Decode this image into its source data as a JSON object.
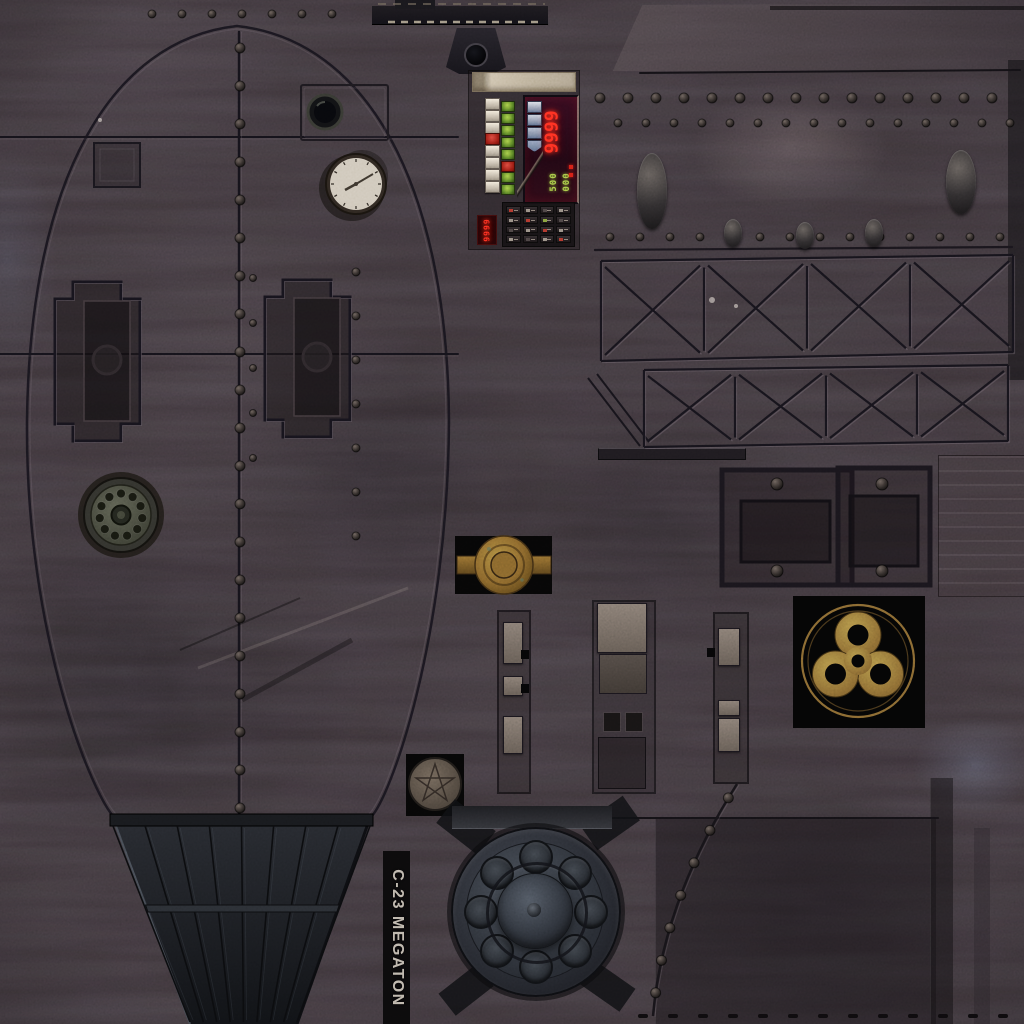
{
  "texture_label": {
    "text": "C-23 MEGATON"
  },
  "control_panel": {
    "main_display": {
      "value": "9999"
    },
    "aux_display": {
      "line1": "500",
      "line2": "000"
    },
    "side_display": {
      "value": "9999"
    },
    "left_buttons": [
      "white",
      "white",
      "white",
      "red",
      "white",
      "white",
      "white",
      "white"
    ],
    "right_buttons": [
      "green",
      "green",
      "green",
      "green",
      "green",
      "red",
      "green",
      "green"
    ],
    "display_buttons": [
      "#d7dce4",
      "#c3cbd8",
      "#a8b4c6",
      "#8799b6"
    ],
    "display_indicators": [
      "#d01e14",
      "#d01e14"
    ],
    "keypad_indicators": [
      "#a8342a",
      "#8d857a",
      "#46403f",
      "#8d857a",
      "#8d857a",
      "#a8342a",
      "#7a9a37",
      "#46403f",
      "#46403f",
      "#8d857a",
      "#a8342a",
      "#8d857a",
      "#8d857a",
      "#46403f",
      "#8d857a",
      "#a8342a"
    ]
  },
  "colors": {
    "background": "#332c2f",
    "display_red": "#ff2d1f",
    "display_green": "#9fc544",
    "brass": "#a5823c",
    "hazard_gold": "#a8873f",
    "clock_face": "#cac3b4",
    "stencil_text": "#b5afa3"
  },
  "icons": {
    "biohazard": "biohazard-symbol",
    "clock": "clock-gauge",
    "rotary_dial": "rotary-dial",
    "porthole": "porthole-window",
    "valve_hub": "brass-valve-hub",
    "round_emblem": "worn-round-emblem",
    "lifting_lug": "lifting-lug-bracket"
  }
}
